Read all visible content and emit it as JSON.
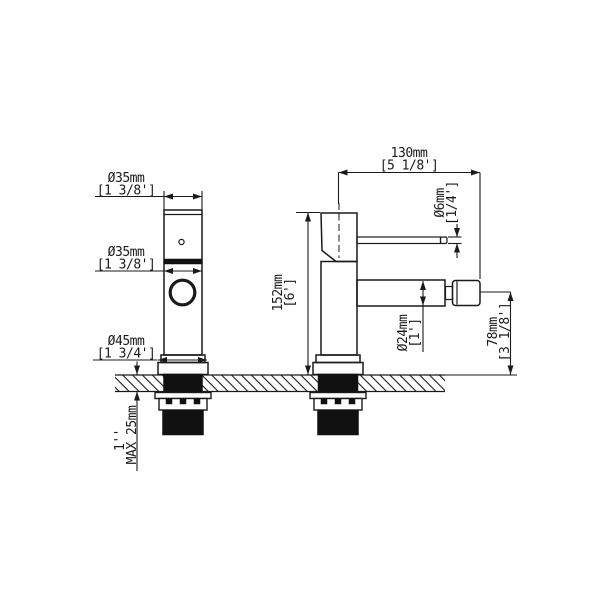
{
  "labels": {
    "front": {
      "handle_dia": {
        "mm": "Ø35mm",
        "inch": "[1 3/8']"
      },
      "body_dia": {
        "mm": "Ø35mm",
        "inch": "[1 3/8']"
      },
      "base_dia": {
        "mm": "Ø45mm",
        "inch": "[1 3/4']"
      },
      "deck_thickness": {
        "inch": "1''",
        "mm": "MAX 25mm"
      }
    },
    "side": {
      "spout_reach": {
        "mm": "130mm",
        "inch": "[5 1/8']"
      },
      "lever_dia": {
        "mm": "Ø6mm",
        "inch": "[1/4']"
      },
      "total_height": {
        "mm": "152mm",
        "inch": "[6']"
      },
      "spout_dia": {
        "mm": "Ø24mm",
        "inch": "[1']"
      },
      "spout_height": {
        "mm": "78mm",
        "inch": "[3 1/8']"
      }
    }
  },
  "colors": {
    "line": "#1a1a1a",
    "dark_fill": "#111111",
    "background": "#ffffff"
  }
}
